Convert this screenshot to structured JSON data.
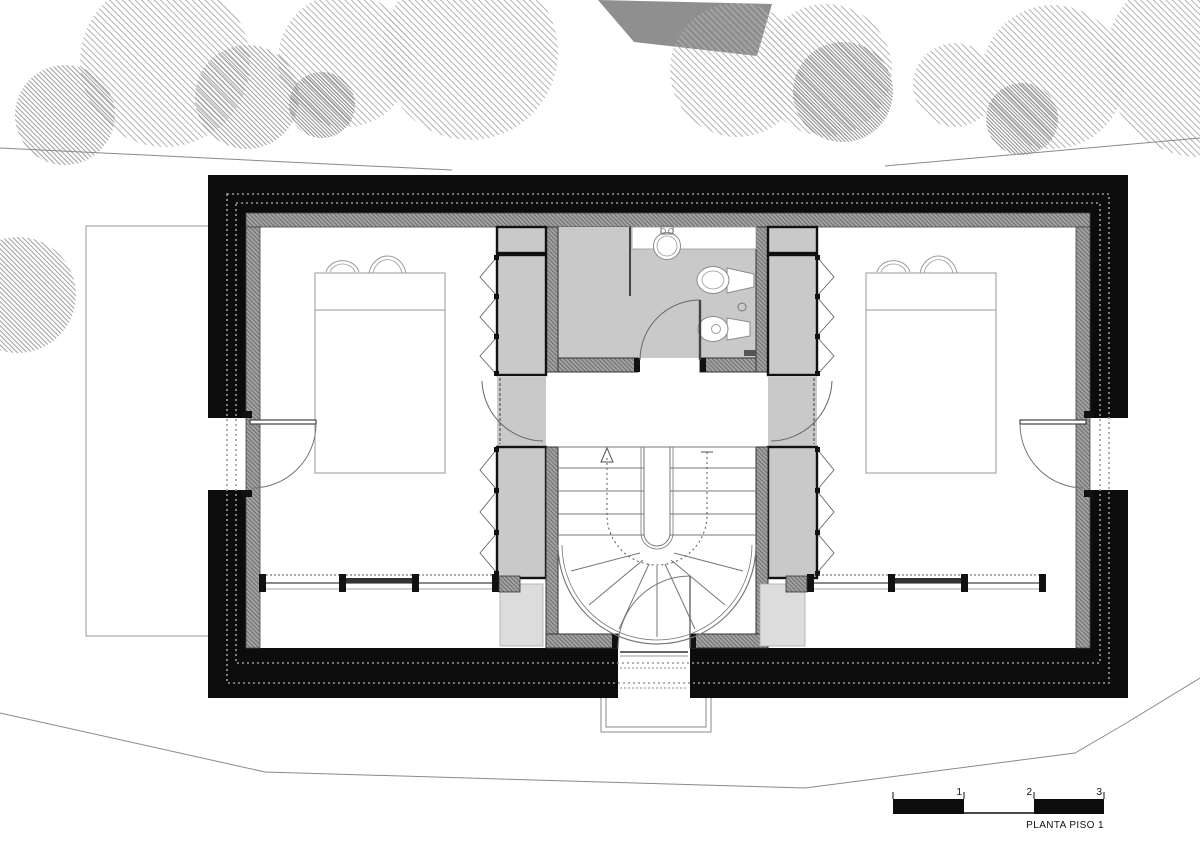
{
  "plan": {
    "title": "PLANTA PISO 1",
    "scale_bar": {
      "tick_labels": [
        "1",
        "2",
        "3"
      ],
      "units": "meters"
    }
  },
  "colors": {
    "wall_black": "#0c0c0c",
    "partition_hatch_gray": "#9c9c9c",
    "closet_floor_gray": "#c9c9c9",
    "light_gray_box": "#dcdcdc",
    "tree_hatch_gray": "#a8a8a8",
    "dark_roof_polygon": "#8f8f8f",
    "line_dark": "#555555",
    "background": "#ffffff"
  },
  "symbols": [
    "tree-canopy",
    "terrain-contour-line",
    "adjacent-roof",
    "terrace-outline",
    "exterior-wall",
    "insulation-dotted-line",
    "interior-lining-wall",
    "bedroom-left",
    "bedroom-right",
    "bathroom",
    "landing",
    "stair-hall",
    "wardrobe",
    "folding-closet-doors",
    "door-swing",
    "bed",
    "pillows",
    "washbasin",
    "toilet",
    "bidet",
    "spiral-stair",
    "walk-line-arrow",
    "window-strip",
    "balcony-step",
    "scale-bar"
  ]
}
